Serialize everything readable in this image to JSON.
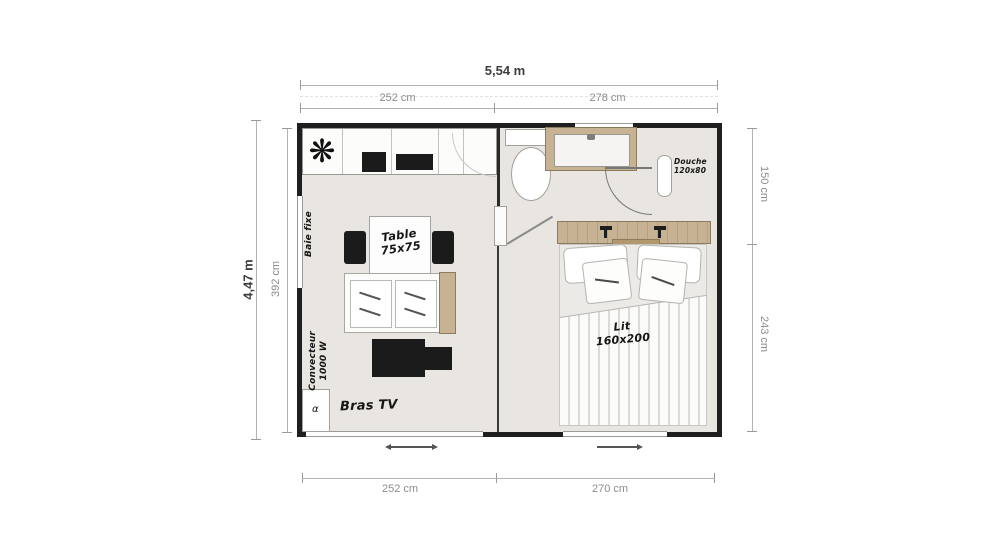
{
  "dimensions": {
    "top_total": "5,54 m",
    "top_left_section": "252 cm",
    "top_right_section": "278 cm",
    "left_total": "4,47 m",
    "left_inner": "392 cm",
    "right_top_section": "150 cm",
    "right_bottom_section": "243 cm",
    "bottom_left_section": "252 cm",
    "bottom_right_section": "270 cm"
  },
  "labels": {
    "table": "Table\n75x75",
    "bed": "Lit\n160x200",
    "shower": "Douche\n120x80",
    "tv_arm": "Bras TV",
    "heater": "Convecteur\n1000 W",
    "fixed_window": "Baie fixe",
    "corner_unit": "α"
  },
  "icons": {
    "fan": "❋"
  },
  "colors": {
    "wall": "#1f1f1f",
    "floor": "#e9e5e0",
    "wood": "#c7b294",
    "dim_line": "#b3b3b3",
    "dim_text": "#8c8c8c",
    "dim_text_strong": "#3d3d3d"
  }
}
